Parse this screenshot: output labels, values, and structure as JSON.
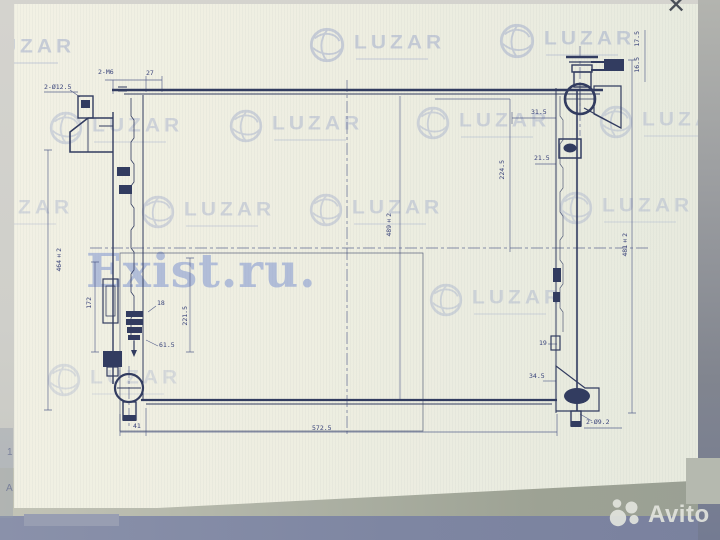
{
  "window": {
    "close_icon": "✕"
  },
  "brand_watermark": {
    "logo_text": "LUZAR",
    "site_watermark": "Exist.ru."
  },
  "marketplace": {
    "brand": "Avito"
  },
  "background_glyphs": {
    "g1": "1",
    "g2": "A"
  },
  "drawing": {
    "dimensions": {
      "holes_top_left": "2-Ø12.5",
      "studs_top_left": "2-M6",
      "offset_top_left": "27",
      "neck_a": "17.5",
      "neck_b": "16.5",
      "right_upper_a": "31.5",
      "right_upper_b": "21.5",
      "right_span": "224.5",
      "core_height": "489±2",
      "left_height": "464±2",
      "right_height": "481±2",
      "left_span": "172",
      "left_mid_span": "221.5",
      "left_gap": "18",
      "left_pipe": "61.5",
      "right_gap": "19",
      "right_foot": "34.5",
      "bottom_left": "41",
      "bottom_span": "572.5",
      "holes_bottom_right": "2-Ø9.2"
    }
  },
  "colors": {
    "paper": "#f0efe2",
    "line": "#323c60",
    "watermark": "#8e9cc6",
    "exist": "#8499d0",
    "footer": "#7e86a2",
    "avito_text": "#e2e4dd"
  }
}
